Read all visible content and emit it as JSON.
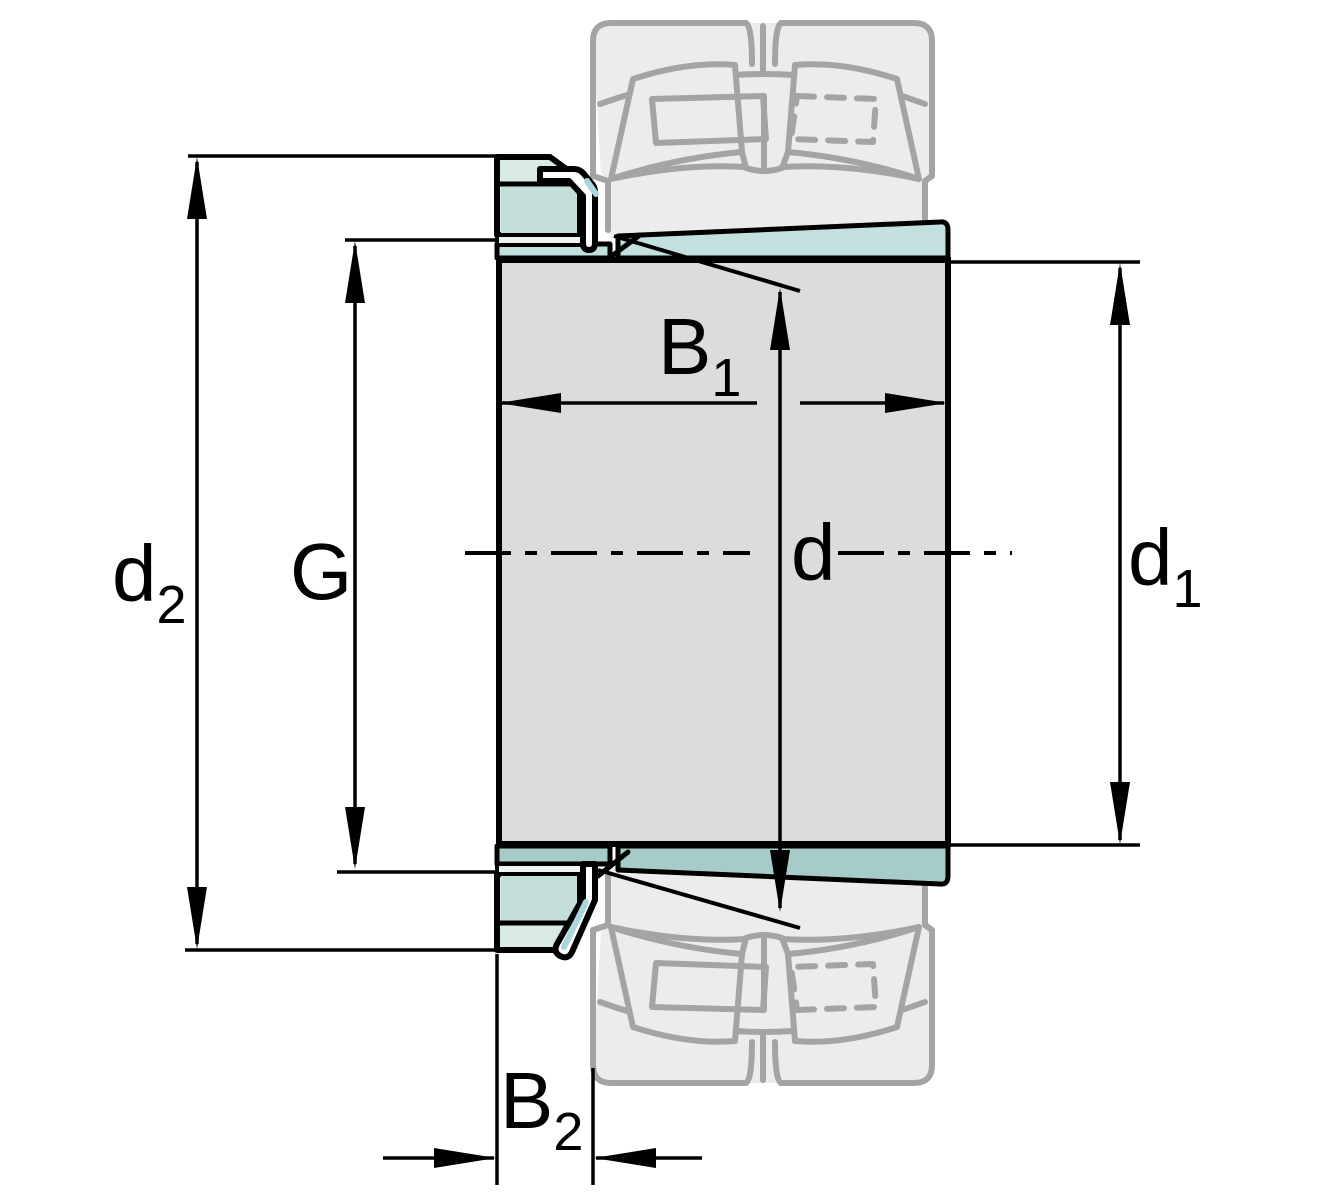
{
  "drawing": {
    "type": "engineering-cross-section",
    "subject": "adapter sleeve with lock nut, lock washer and spherical roller bearing silhouette",
    "dimension_labels": {
      "d2": {
        "base": "d",
        "subscript": "2"
      },
      "g": {
        "base": "G",
        "subscript": ""
      },
      "b1": {
        "base": "B",
        "subscript": "1"
      },
      "d": {
        "base": "d",
        "subscript": ""
      },
      "d1": {
        "base": "d",
        "subscript": "1"
      },
      "b2": {
        "base": "B",
        "subscript": "2"
      }
    },
    "colors": {
      "background": "#ffffff",
      "body_grey": "#dcdcdc",
      "sleeve_teal": "#c2e1de",
      "sleeve_teal_shaded": "#a6cbc9",
      "nut_teal_light": "#d9e9e5",
      "nut_teal": "#c3ddd8",
      "washer_plate": "#edf4f2",
      "washer_accent": "#abd6dc",
      "bearing_fill": "#ececec",
      "bearing_stroke": "#a4a4a4",
      "line_black": "#000000"
    }
  }
}
